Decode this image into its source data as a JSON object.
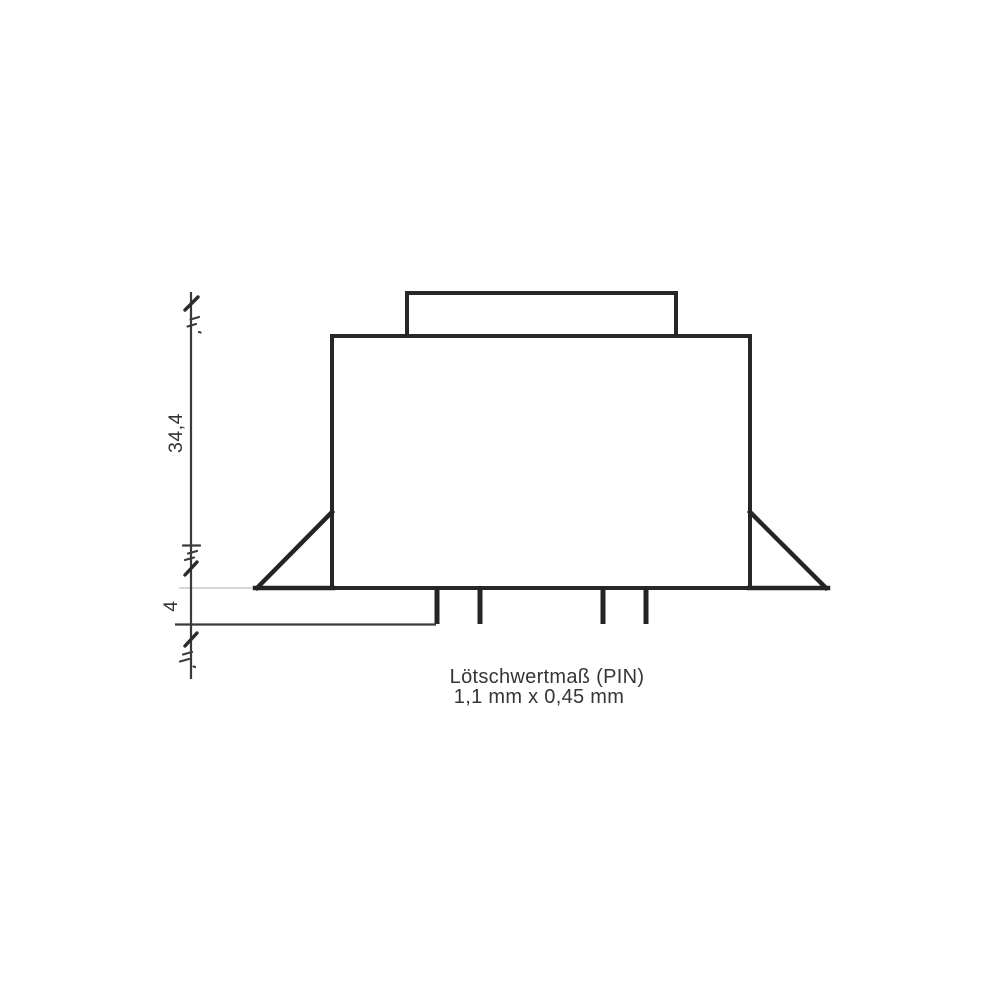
{
  "drawing": {
    "labels": {
      "height_dim": "34,4",
      "pin_dim": "4"
    },
    "caption": {
      "line1": "Lötschwertmaß (PIN)",
      "line2": "1,1 mm x 0,45 mm"
    },
    "colors": {
      "outline": "#272727",
      "dimension_line": "#3a3a3a",
      "text": "#333333",
      "background": "#ffffff"
    }
  }
}
